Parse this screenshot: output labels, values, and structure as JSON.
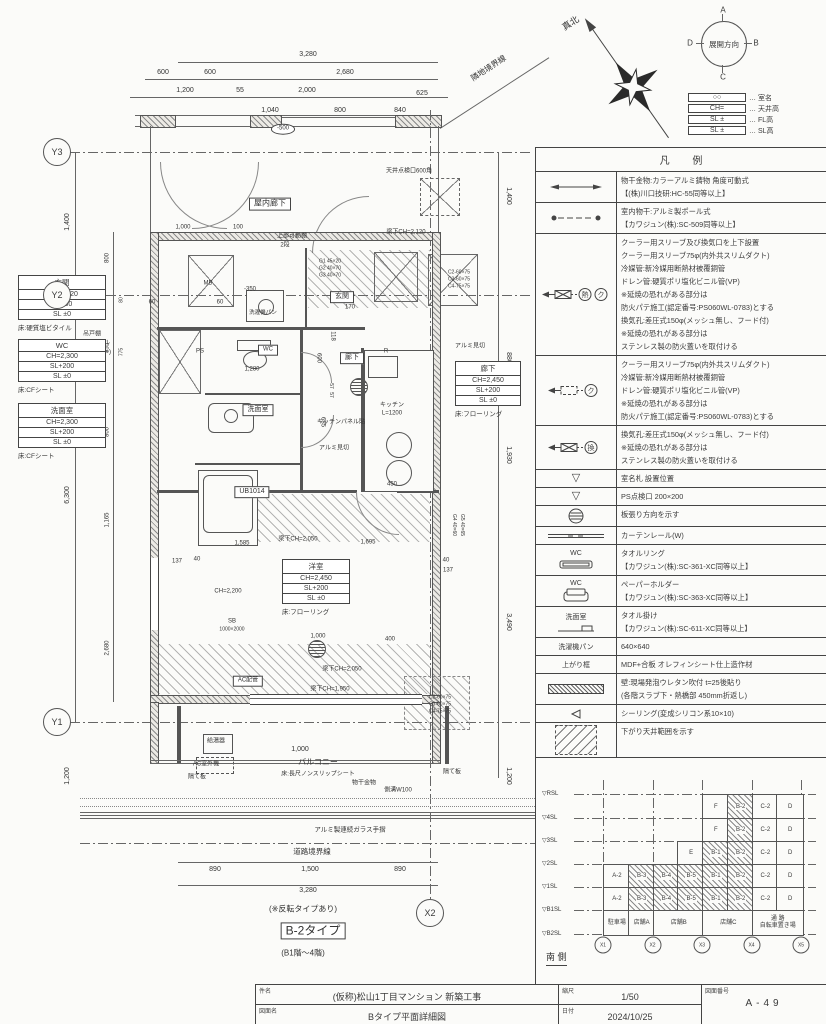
{
  "title_block": {
    "kenmei_label": "件名",
    "kenmei": "(仮称)松山1丁目マンション  新築工事",
    "zumenmei_label": "図面名",
    "zumenmei": "Bタイプ平面詳細図",
    "shukushaku_label": "縮尺",
    "shukushaku": "1/50",
    "hizuke_label": "日付",
    "hizuke": "2024/10/25",
    "zuban_label": "図面番号",
    "zuban": "A-49"
  },
  "compass": {
    "label": "展開方向",
    "dirs": {
      "top": "A",
      "right": "B",
      "bottom": "C",
      "left": "D"
    }
  },
  "key_table": [
    {
      "sym": "○○",
      "label": "… 室名"
    },
    {
      "sym": "CH=",
      "label": "… 天井高"
    },
    {
      "sym": "SL ±",
      "label": "… FL高"
    },
    {
      "sym": "SL ±",
      "label": "… SL高"
    }
  ],
  "legend": {
    "title": "凡  例",
    "rows": [
      {
        "sym": "a2",
        "lines": [
          "物干金物:カラーアルミ鋳物  角度可動式",
          "【(株)川口技研:HC-55同等以上】"
        ]
      },
      {
        "sym": "ad",
        "lines": [
          "室内物干:アルミ製ポール式",
          "【カワジュン(株):SC-509同等以上】"
        ]
      },
      {
        "sym": "shk",
        "lines": [
          "クーラー用スリーブ及び換気口を上下設置",
          "クーラー用スリーブ75φ(内外共スリムダクト)",
          "冷媒管:新冷媒用断熱材被覆銅管",
          "ドレン管:硬質ポリ塩化ビニル管(VP)",
          "※延焼の恐れがある部分は",
          "防火パテ施工(認定番号:PS060WL-0783)とする",
          "換気孔:差圧式150φ(メッシュ無し、フード付)",
          "※延焼の恐れがある部分は",
          "ステンレス製の防火蓋いを取付ける"
        ]
      },
      {
        "sym": "sk",
        "lines": [
          "クーラー用スリーブ75φ(内外共スリムダクト)",
          "冷媒管:新冷媒用断熱材被覆銅管",
          "ドレン管:硬質ポリ塩化ビニル管(VP)",
          "※延焼の恐れがある部分は",
          "防火パテ施工(認定番号:PS060WL-0783)とする"
        ]
      },
      {
        "sym": "vh",
        "lines": [
          "換気孔:差圧式150φ(メッシュ無し、フード付)",
          "※延焼の恐れがある部分は",
          "ステンレス製の防火蓋いを取付ける"
        ]
      },
      {
        "sym": "tri",
        "lines": [
          "室名札 設置位置"
        ]
      },
      {
        "sym": "tri",
        "lines": [
          "PS点検口 200×200"
        ]
      },
      {
        "sym": "sc",
        "lines": [
          "板張り方向を示す"
        ]
      },
      {
        "sym": "rail",
        "lines": [
          "カーテンレール(W)"
        ]
      },
      {
        "sym": "ring",
        "cap": "WC",
        "lines": [
          "タオルリング",
          "【カワジュン(株):SC-361-XC同等以上】"
        ]
      },
      {
        "sym": "holder",
        "cap": "WC",
        "lines": [
          "ペーパーホルダー",
          "【カワジュン(株):SC-363-XC同等以上】"
        ]
      },
      {
        "sym": "bar",
        "cap": "洗面室",
        "lines": [
          "タオル掛け",
          "【カワジュン(株):SC-611-XC同等以上】"
        ]
      },
      {
        "sym": "none",
        "cap": "洗濯機パン",
        "lines": [
          "640×640"
        ]
      },
      {
        "sym": "none",
        "cap": "上がり框",
        "lines": [
          "MDF+合板  オレフィンシート仕上造作材"
        ]
      },
      {
        "sym": "wall",
        "lines": [
          "壁:現場発泡ウレタン吹付 t=25後貼り",
          "(各階スラブ下・熱橋部 450mm折返し)"
        ]
      },
      {
        "sym": "seal",
        "lines": [
          "シーリング(変成シリコン系10×10)"
        ]
      },
      {
        "sym": "drop",
        "lines": [
          "下がり天井範囲を示す"
        ]
      }
    ]
  },
  "elevation": {
    "label": "南 側",
    "levels": [
      {
        "t": "▽RSL",
        "y": 36
      },
      {
        "t": "▽4SL",
        "y": 60
      },
      {
        "t": "▽3SL",
        "y": 83
      },
      {
        "t": "▽2SL",
        "y": 106
      },
      {
        "t": "▽1SL",
        "y": 129
      },
      {
        "t": "▽B1SL",
        "y": 152
      },
      {
        "t": "▽B2SL",
        "y": 176
      }
    ],
    "bubbles": [
      "X1",
      "X2",
      "X3",
      "X4",
      "X5"
    ],
    "rows": [
      {
        "cells": [
          {
            "c": 4,
            "t": "F"
          },
          {
            "c": 5,
            "t": "B-2",
            "h": 1
          },
          {
            "c": 6,
            "t": "C-2"
          },
          {
            "c": 7,
            "t": "D"
          }
        ]
      },
      {
        "cells": [
          {
            "c": 4,
            "t": "F"
          },
          {
            "c": 5,
            "t": "B-2",
            "h": 1
          },
          {
            "c": 6,
            "t": "C-2"
          },
          {
            "c": 7,
            "t": "D"
          }
        ]
      },
      {
        "cells": [
          {
            "c": 3,
            "t": "E"
          },
          {
            "c": 4,
            "t": "B-1",
            "h": 1
          },
          {
            "c": 5,
            "t": "B-2",
            "h": 1
          },
          {
            "c": 6,
            "t": "C-2"
          },
          {
            "c": 7,
            "t": "D"
          }
        ]
      },
      {
        "cells": [
          {
            "c": 0,
            "t": "A-2"
          },
          {
            "c": 1,
            "t": "B-3",
            "h": 1
          },
          {
            "c": 2,
            "t": "B-4",
            "h": 1
          },
          {
            "c": 3,
            "t": "B-5",
            "h": 1
          },
          {
            "c": 4,
            "t": "B-1",
            "h": 1
          },
          {
            "c": 5,
            "t": "B-2",
            "h": 1
          },
          {
            "c": 6,
            "t": "C-2"
          },
          {
            "c": 7,
            "t": "D"
          }
        ]
      },
      {
        "cells": [
          {
            "c": 0,
            "t": "A-2"
          },
          {
            "c": 1,
            "t": "B-3",
            "h": 1
          },
          {
            "c": 2,
            "t": "B-4",
            "h": 1
          },
          {
            "c": 3,
            "t": "B-5",
            "h": 1
          },
          {
            "c": 4,
            "t": "B-1",
            "h": 1
          },
          {
            "c": 5,
            "t": "B-2",
            "h": 1
          },
          {
            "c": 6,
            "t": "C-2"
          },
          {
            "c": 7,
            "t": "D"
          }
        ]
      },
      {
        "cells": [
          {
            "c": 0,
            "t": "駐車場"
          },
          {
            "c": 1,
            "t": "店舗A"
          },
          {
            "c": 2,
            "t": "店舗B",
            "span": 2
          },
          {
            "c": 4,
            "t": "店舗C",
            "span": 2
          },
          {
            "c": 6,
            "t": "通 路\n自転車置き場",
            "span": 2
          }
        ]
      }
    ]
  },
  "plan": {
    "bubbles": [
      {
        "t": "Y3",
        "x": 57,
        "y": 152
      },
      {
        "t": "Y2",
        "x": 57,
        "y": 295
      },
      {
        "t": "Y1",
        "x": 57,
        "y": 722
      },
      {
        "t": "X2",
        "x": 430,
        "y": 913
      }
    ],
    "room_tags": [
      {
        "x": 18,
        "y": 276,
        "w": 88,
        "name": "玄関",
        "ch": "CH=2,620",
        "fl": "SL+30",
        "sl": "SL ±0",
        "note": "床:硬質塩ビタイル"
      },
      {
        "x": 18,
        "y": 340,
        "w": 88,
        "name": "WC",
        "ch": "CH=2,300",
        "fl": "SL+200",
        "sl": "SL ±0",
        "note": "床:CFシート"
      },
      {
        "x": 18,
        "y": 404,
        "w": 88,
        "name": "洗面室",
        "ch": "CH=2,300",
        "fl": "SL+200",
        "sl": "SL ±0",
        "note": "床:CFシート"
      },
      {
        "x": 455,
        "y": 362,
        "w": 66,
        "name": "廊下",
        "ch": "CH=2,450",
        "fl": "SL+200",
        "sl": "SL ±0",
        "note": "床:フローリング"
      },
      {
        "x": 282,
        "y": 560,
        "w": 68,
        "name": "洋室",
        "ch": "CH=2,450",
        "fl": "SL+200",
        "sl": "SL ±0",
        "note": "床:フローリング"
      }
    ],
    "labels": [
      {
        "t": "真北",
        "x": 571,
        "y": 24,
        "r": -33,
        "s": 9
      },
      {
        "t": "3,280",
        "x": 308,
        "y": 55
      },
      {
        "t": "600",
        "x": 163,
        "y": 73
      },
      {
        "t": "600",
        "x": 210,
        "y": 73
      },
      {
        "t": "2,680",
        "x": 345,
        "y": 73
      },
      {
        "t": "隣地境界線",
        "x": 489,
        "y": 69,
        "r": -33,
        "s": 8
      },
      {
        "t": "1,200",
        "x": 185,
        "y": 91
      },
      {
        "t": "55",
        "x": 240,
        "y": 91
      },
      {
        "t": "2,000",
        "x": 307,
        "y": 91
      },
      {
        "t": "625",
        "x": 422,
        "y": 94
      },
      {
        "t": "1,040",
        "x": 270,
        "y": 111
      },
      {
        "t": "800",
        "x": 340,
        "y": 111
      },
      {
        "t": "840",
        "x": 400,
        "y": 111
      },
      {
        "t": "-500",
        "x": 283,
        "y": 129,
        "o": 1,
        "s": 6
      },
      {
        "t": "天井点検口600角",
        "x": 409,
        "y": 172,
        "s": 6
      },
      {
        "t": "屋内廊下",
        "x": 270,
        "y": 204,
        "b": 1,
        "s": 8
      },
      {
        "t": "1,000",
        "x": 183,
        "y": 228,
        "s": 6
      },
      {
        "t": "100",
        "x": 238,
        "y": 228,
        "s": 6
      },
      {
        "t": "上部可動棚",
        "x": 292,
        "y": 237,
        "s": 6
      },
      {
        "t": "2段",
        "x": 285,
        "y": 246,
        "s": 6
      },
      {
        "t": "梁下CH=2,120",
        "x": 406,
        "y": 233,
        "s": 6
      },
      {
        "t": "MB",
        "x": 208,
        "y": 284,
        "s": 6
      },
      {
        "t": "G1 45×20",
        "x": 330,
        "y": 262,
        "s": 5
      },
      {
        "t": "G2 40×70",
        "x": 330,
        "y": 269,
        "s": 5
      },
      {
        "t": "G3 40×70",
        "x": 330,
        "y": 276,
        "s": 5
      },
      {
        "t": "玄関",
        "x": 342,
        "y": 297,
        "b": 1,
        "s": 7
      },
      {
        "t": "C2-60×75",
        "x": 459,
        "y": 273,
        "s": 5
      },
      {
        "t": "C3-60×75",
        "x": 459,
        "y": 280,
        "s": 5
      },
      {
        "t": "C4-75×75",
        "x": 459,
        "y": 287,
        "s": 5
      },
      {
        "t": "60",
        "x": 152,
        "y": 303,
        "s": 6
      },
      {
        "t": "60",
        "x": 220,
        "y": 303,
        "s": 6
      },
      {
        "t": "-350",
        "x": 250,
        "y": 290,
        "s": 6
      },
      {
        "t": "170",
        "x": 350,
        "y": 308,
        "s": 6
      },
      {
        "t": "118",
        "x": 332,
        "y": 336,
        "s": 6,
        "r": 90
      },
      {
        "t": "洗濯機パン",
        "x": 263,
        "y": 313,
        "s": 5.5
      },
      {
        "t": "吊戸棚",
        "x": 92,
        "y": 335,
        "s": 6
      },
      {
        "t": "(TOTO:ウォール",
        "x": 88,
        "y": 344,
        "s": 6
      },
      {
        "t": "キャビネット)",
        "x": 92,
        "y": 353,
        "s": 6
      },
      {
        "t": "PS",
        "x": 200,
        "y": 352,
        "s": 6
      },
      {
        "t": "WC",
        "x": 268,
        "y": 350,
        "b": 1,
        "s": 6
      },
      {
        "t": "1,280",
        "x": 252,
        "y": 370,
        "s": 6
      },
      {
        "t": "600",
        "x": 318,
        "y": 358,
        "s": 6,
        "r": 90
      },
      {
        "t": "57",
        "x": 330,
        "y": 386,
        "s": 5,
        "r": 90
      },
      {
        "t": "57",
        "x": 330,
        "y": 395,
        "s": 5,
        "r": 90
      },
      {
        "t": "685",
        "x": 322,
        "y": 422,
        "s": 6,
        "r": 90
      },
      {
        "t": "廊下",
        "x": 352,
        "y": 358,
        "b": 1,
        "s": 7
      },
      {
        "t": "R",
        "x": 386,
        "y": 352,
        "s": 6
      },
      {
        "t": "キッチン",
        "x": 392,
        "y": 406,
        "s": 6
      },
      {
        "t": "L=1200",
        "x": 392,
        "y": 414,
        "s": 6
      },
      {
        "t": "キッチンパネル貼",
        "x": 341,
        "y": 423,
        "s": 6
      },
      {
        "t": "アルミ見切",
        "x": 470,
        "y": 347,
        "s": 6
      },
      {
        "t": "アルミ見切",
        "x": 334,
        "y": 449,
        "s": 6
      },
      {
        "t": "洗面室",
        "x": 258,
        "y": 410,
        "b": 1,
        "s": 7
      },
      {
        "t": "UB1014",
        "x": 252,
        "y": 492,
        "b": 1,
        "s": 7
      },
      {
        "t": "450",
        "x": 392,
        "y": 485,
        "s": 6
      },
      {
        "t": "1,585",
        "x": 242,
        "y": 544,
        "s": 6
      },
      {
        "t": "梁下CH=2,050",
        "x": 298,
        "y": 540,
        "s": 6
      },
      {
        "t": "1,695",
        "x": 368,
        "y": 543,
        "s": 6
      },
      {
        "t": "137",
        "x": 177,
        "y": 562,
        "s": 6
      },
      {
        "t": "40",
        "x": 197,
        "y": 560,
        "s": 6
      },
      {
        "t": "40",
        "x": 446,
        "y": 561,
        "s": 6
      },
      {
        "t": "137",
        "x": 448,
        "y": 571,
        "s": 6
      },
      {
        "t": "G4 40×60",
        "x": 453,
        "y": 525,
        "s": 5,
        "r": 90
      },
      {
        "t": "G5 40×65",
        "x": 461,
        "y": 525,
        "s": 5,
        "r": 90
      },
      {
        "t": "CH=2,200",
        "x": 228,
        "y": 592,
        "s": 6
      },
      {
        "t": "SB",
        "x": 232,
        "y": 622,
        "s": 6
      },
      {
        "t": "1000×2000",
        "x": 232,
        "y": 630,
        "s": 5
      },
      {
        "t": "1,000",
        "x": 318,
        "y": 637,
        "s": 6
      },
      {
        "t": "400",
        "x": 390,
        "y": 640,
        "s": 6
      },
      {
        "t": "梁下CH=2,050",
        "x": 342,
        "y": 670,
        "s": 6
      },
      {
        "t": "AC配管",
        "x": 248,
        "y": 681,
        "s": 6,
        "b": 1
      },
      {
        "t": "梁下CH=1,950",
        "x": 330,
        "y": 690,
        "s": 6
      },
      {
        "t": "C2-60×75",
        "x": 440,
        "y": 698,
        "s": 5
      },
      {
        "t": "C3-60×75",
        "x": 440,
        "y": 705,
        "s": 5
      },
      {
        "t": "C4-75×75",
        "x": 440,
        "y": 712,
        "s": 5
      },
      {
        "t": "給湯器",
        "x": 216,
        "y": 742,
        "s": 6
      },
      {
        "t": "AC室外機",
        "x": 206,
        "y": 765,
        "s": 6
      },
      {
        "t": "隔て板",
        "x": 197,
        "y": 778,
        "s": 6
      },
      {
        "t": "隔て板",
        "x": 452,
        "y": 773,
        "s": 6
      },
      {
        "t": "1,000",
        "x": 300,
        "y": 750,
        "s": 7
      },
      {
        "t": "バルコニー",
        "x": 318,
        "y": 763,
        "s": 8
      },
      {
        "t": "床:長尺ノンスリップシート",
        "x": 318,
        "y": 775,
        "s": 6
      },
      {
        "t": "物干金物",
        "x": 364,
        "y": 784,
        "s": 6
      },
      {
        "t": "側溝W100",
        "x": 398,
        "y": 791,
        "s": 6
      },
      {
        "t": "アルミ製連続ガラス手摺",
        "x": 350,
        "y": 830,
        "s": 6.5
      },
      {
        "t": "道路境界線",
        "x": 312,
        "y": 852,
        "s": 7.5
      },
      {
        "t": "890",
        "x": 215,
        "y": 870
      },
      {
        "t": "1,500",
        "x": 310,
        "y": 870
      },
      {
        "t": "890",
        "x": 400,
        "y": 870
      },
      {
        "t": "3,280",
        "x": 308,
        "y": 891
      },
      {
        "t": "(※反転タイプあり)",
        "x": 303,
        "y": 910,
        "s": 8
      },
      {
        "t": "B-2タイプ",
        "x": 313,
        "y": 931,
        "b": 1,
        "s": 12
      },
      {
        "t": "(B1階〜4階)",
        "x": 303,
        "y": 954,
        "s": 8
      },
      {
        "t": "1,400",
        "x": 68,
        "y": 222,
        "r": -90
      },
      {
        "t": "6,300",
        "x": 68,
        "y": 495,
        "r": -90
      },
      {
        "t": "1,200",
        "x": 68,
        "y": 776,
        "r": -90
      },
      {
        "t": "800",
        "x": 108,
        "y": 258,
        "r": -90,
        "s": 6
      },
      {
        "t": "855",
        "x": 108,
        "y": 348,
        "r": -90,
        "s": 6
      },
      {
        "t": "80",
        "x": 122,
        "y": 300,
        "r": -90,
        "s": 5
      },
      {
        "t": "775",
        "x": 122,
        "y": 352,
        "r": -90,
        "s": 5
      },
      {
        "t": "800",
        "x": 108,
        "y": 432,
        "r": -90,
        "s": 6
      },
      {
        "t": "1,165",
        "x": 108,
        "y": 520,
        "r": -90,
        "s": 6
      },
      {
        "t": "2,680",
        "x": 108,
        "y": 648,
        "r": -90,
        "s": 6
      },
      {
        "t": "1,400",
        "x": 508,
        "y": 196,
        "r": 90
      },
      {
        "t": "880",
        "x": 508,
        "y": 358,
        "r": 90
      },
      {
        "t": "1,930",
        "x": 508,
        "y": 455,
        "r": 90
      },
      {
        "t": "3,490",
        "x": 508,
        "y": 622,
        "r": 90
      },
      {
        "t": "1,200",
        "x": 508,
        "y": 776,
        "r": 90
      }
    ]
  }
}
